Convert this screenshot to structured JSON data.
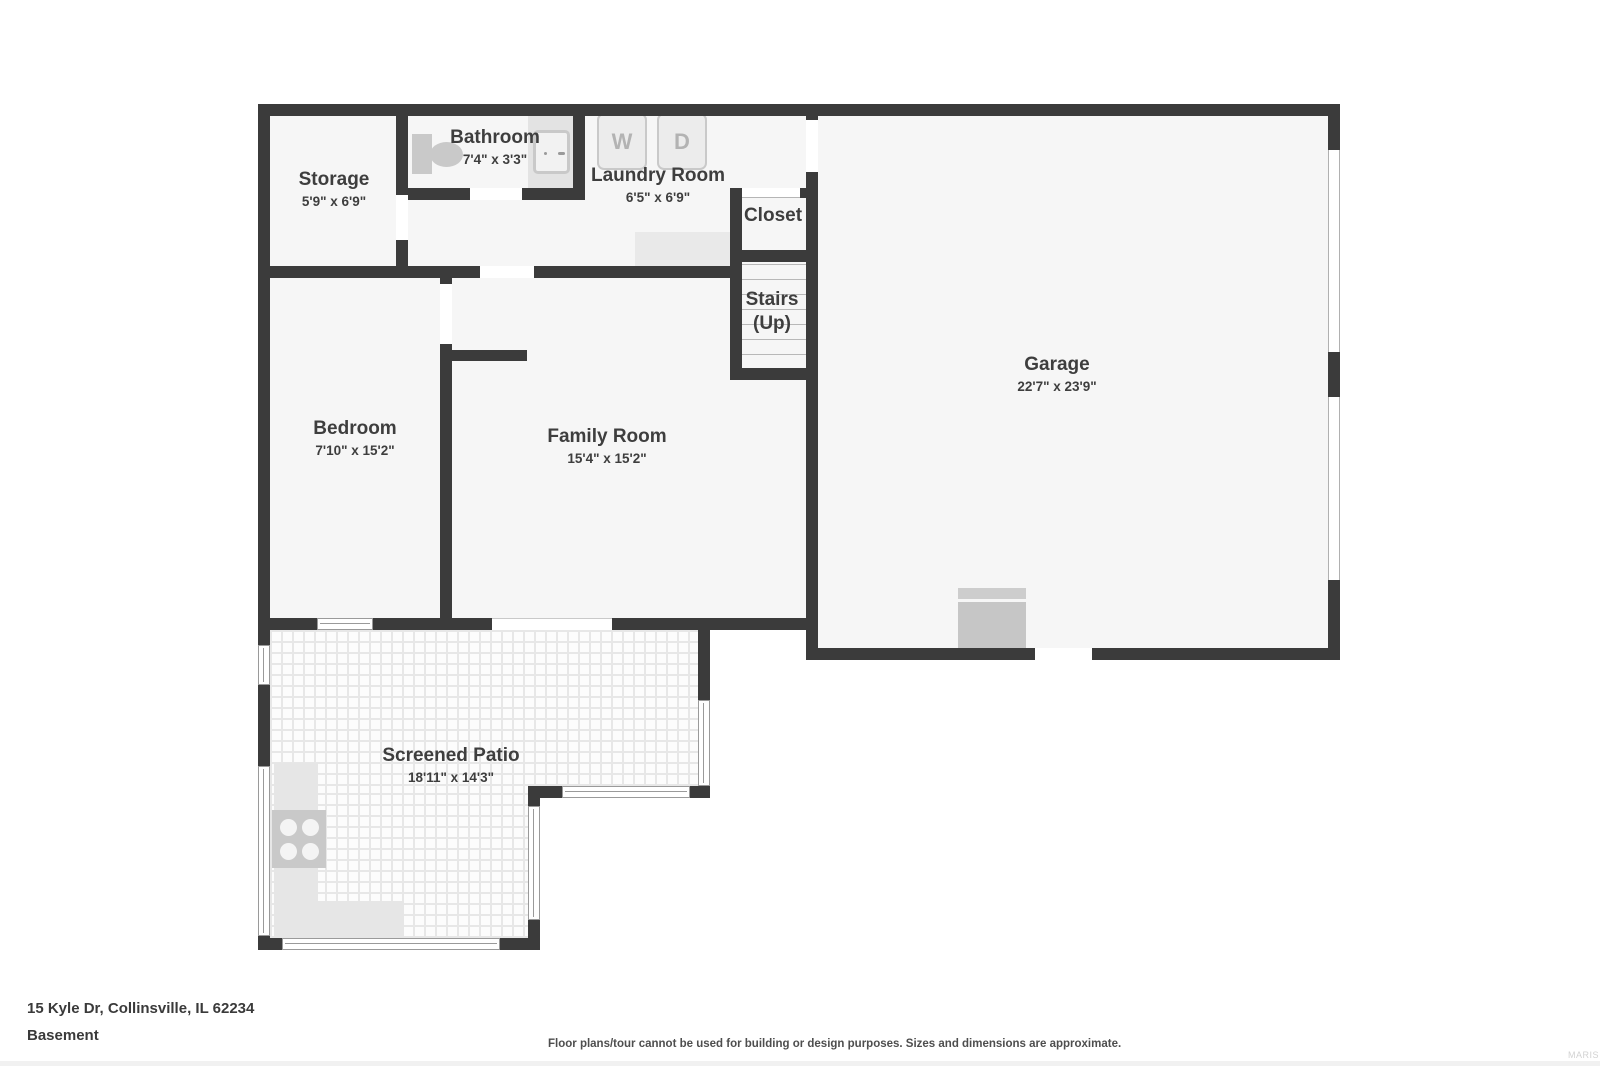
{
  "page": {
    "address": "15 Kyle Dr, Collinsville, IL 62234",
    "floor_label": "Basement",
    "disclaimer": "Floor plans/tour cannot be used for building or design purposes. Sizes and dimensions are approximate.",
    "watermark": "MARIS"
  },
  "rooms": {
    "storage": {
      "name": "Storage",
      "dims": "5'9\" x 6'9\""
    },
    "bathroom": {
      "name": "Bathroom",
      "dims": "7'4\" x 3'3\""
    },
    "laundry": {
      "name": "Laundry Room",
      "dims": "6'5\" x 6'9\""
    },
    "closet": {
      "name": "Closet"
    },
    "stairs": {
      "name": "Stairs",
      "direction": "(Up)"
    },
    "garage": {
      "name": "Garage",
      "dims": "22'7\" x 23'9\""
    },
    "bedroom": {
      "name": "Bedroom",
      "dims": "7'10\" x 15'2\""
    },
    "family_room": {
      "name": "Family Room",
      "dims": "15'4\" x 15'2\""
    },
    "screened_patio": {
      "name": "Screened Patio",
      "dims": "18'11\" x 14'3\""
    }
  },
  "appliances": {
    "washer": "W",
    "dryer": "D"
  },
  "colors": {
    "wall": "#3b3b3b",
    "room_fill": "#f6f6f6",
    "fixture": "#c9c9c9",
    "text": "#3e3e3e"
  }
}
